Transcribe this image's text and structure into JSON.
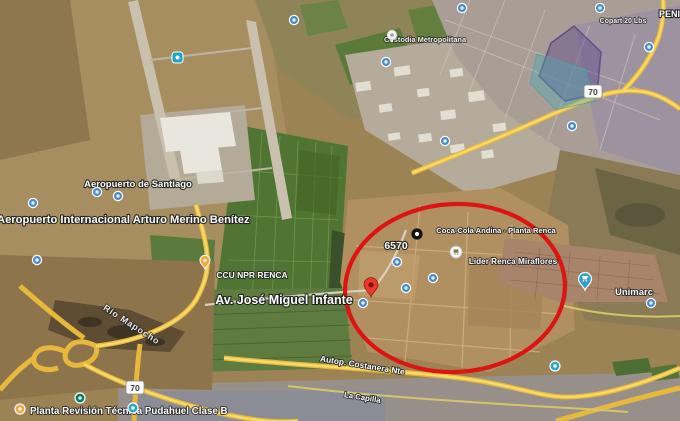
{
  "labels": {
    "airport_short": "Aeropuerto de Santiago",
    "airport_full": "Aeropuerto Internacional Arturo Merino Benítez",
    "ccu_plant": "CCU NPR RENCA",
    "avenue": "Av. José Miguel Infante",
    "street_number": "6570",
    "coca_cola_plant": "Coca-Cola Andina - Planta Renca",
    "lider_store": "Lider Renca Miraflores",
    "unimarc_store": "Unimarc",
    "custodia": "Custodia Metropolitana",
    "copart": "Copart 20 Lbs",
    "peni_partial": "PENI",
    "river": "Río Mapocho",
    "highway": "Autop. Costanera Nte",
    "street_capilla": "La Capilla",
    "revision_plant": "Planta Revisión Técnica Pudahuel Clase B"
  },
  "route_shields": {
    "west": "70",
    "northeast": "70"
  },
  "annotation": {
    "type": "ellipse",
    "stroke": "#dd1512"
  },
  "colors": {
    "annotation_red": "#dd1512",
    "road_yellow": "#ecc94f",
    "pin_red": "#e8392c",
    "poi_blue": "#4b8bca",
    "overlay_purple": "rgba(88,70,138,0.42)",
    "overlay_teal": "rgba(72,170,185,0.38)",
    "field_green": "#4f7433",
    "terrain_tan": "#9c8355"
  },
  "icons": {
    "red_pin": "dropped-location-pin",
    "poi_dot": "poi-circle-icon",
    "shopping_pin": "store-pin",
    "route_shield": "highway-shield",
    "black_dot": "point-marker"
  }
}
